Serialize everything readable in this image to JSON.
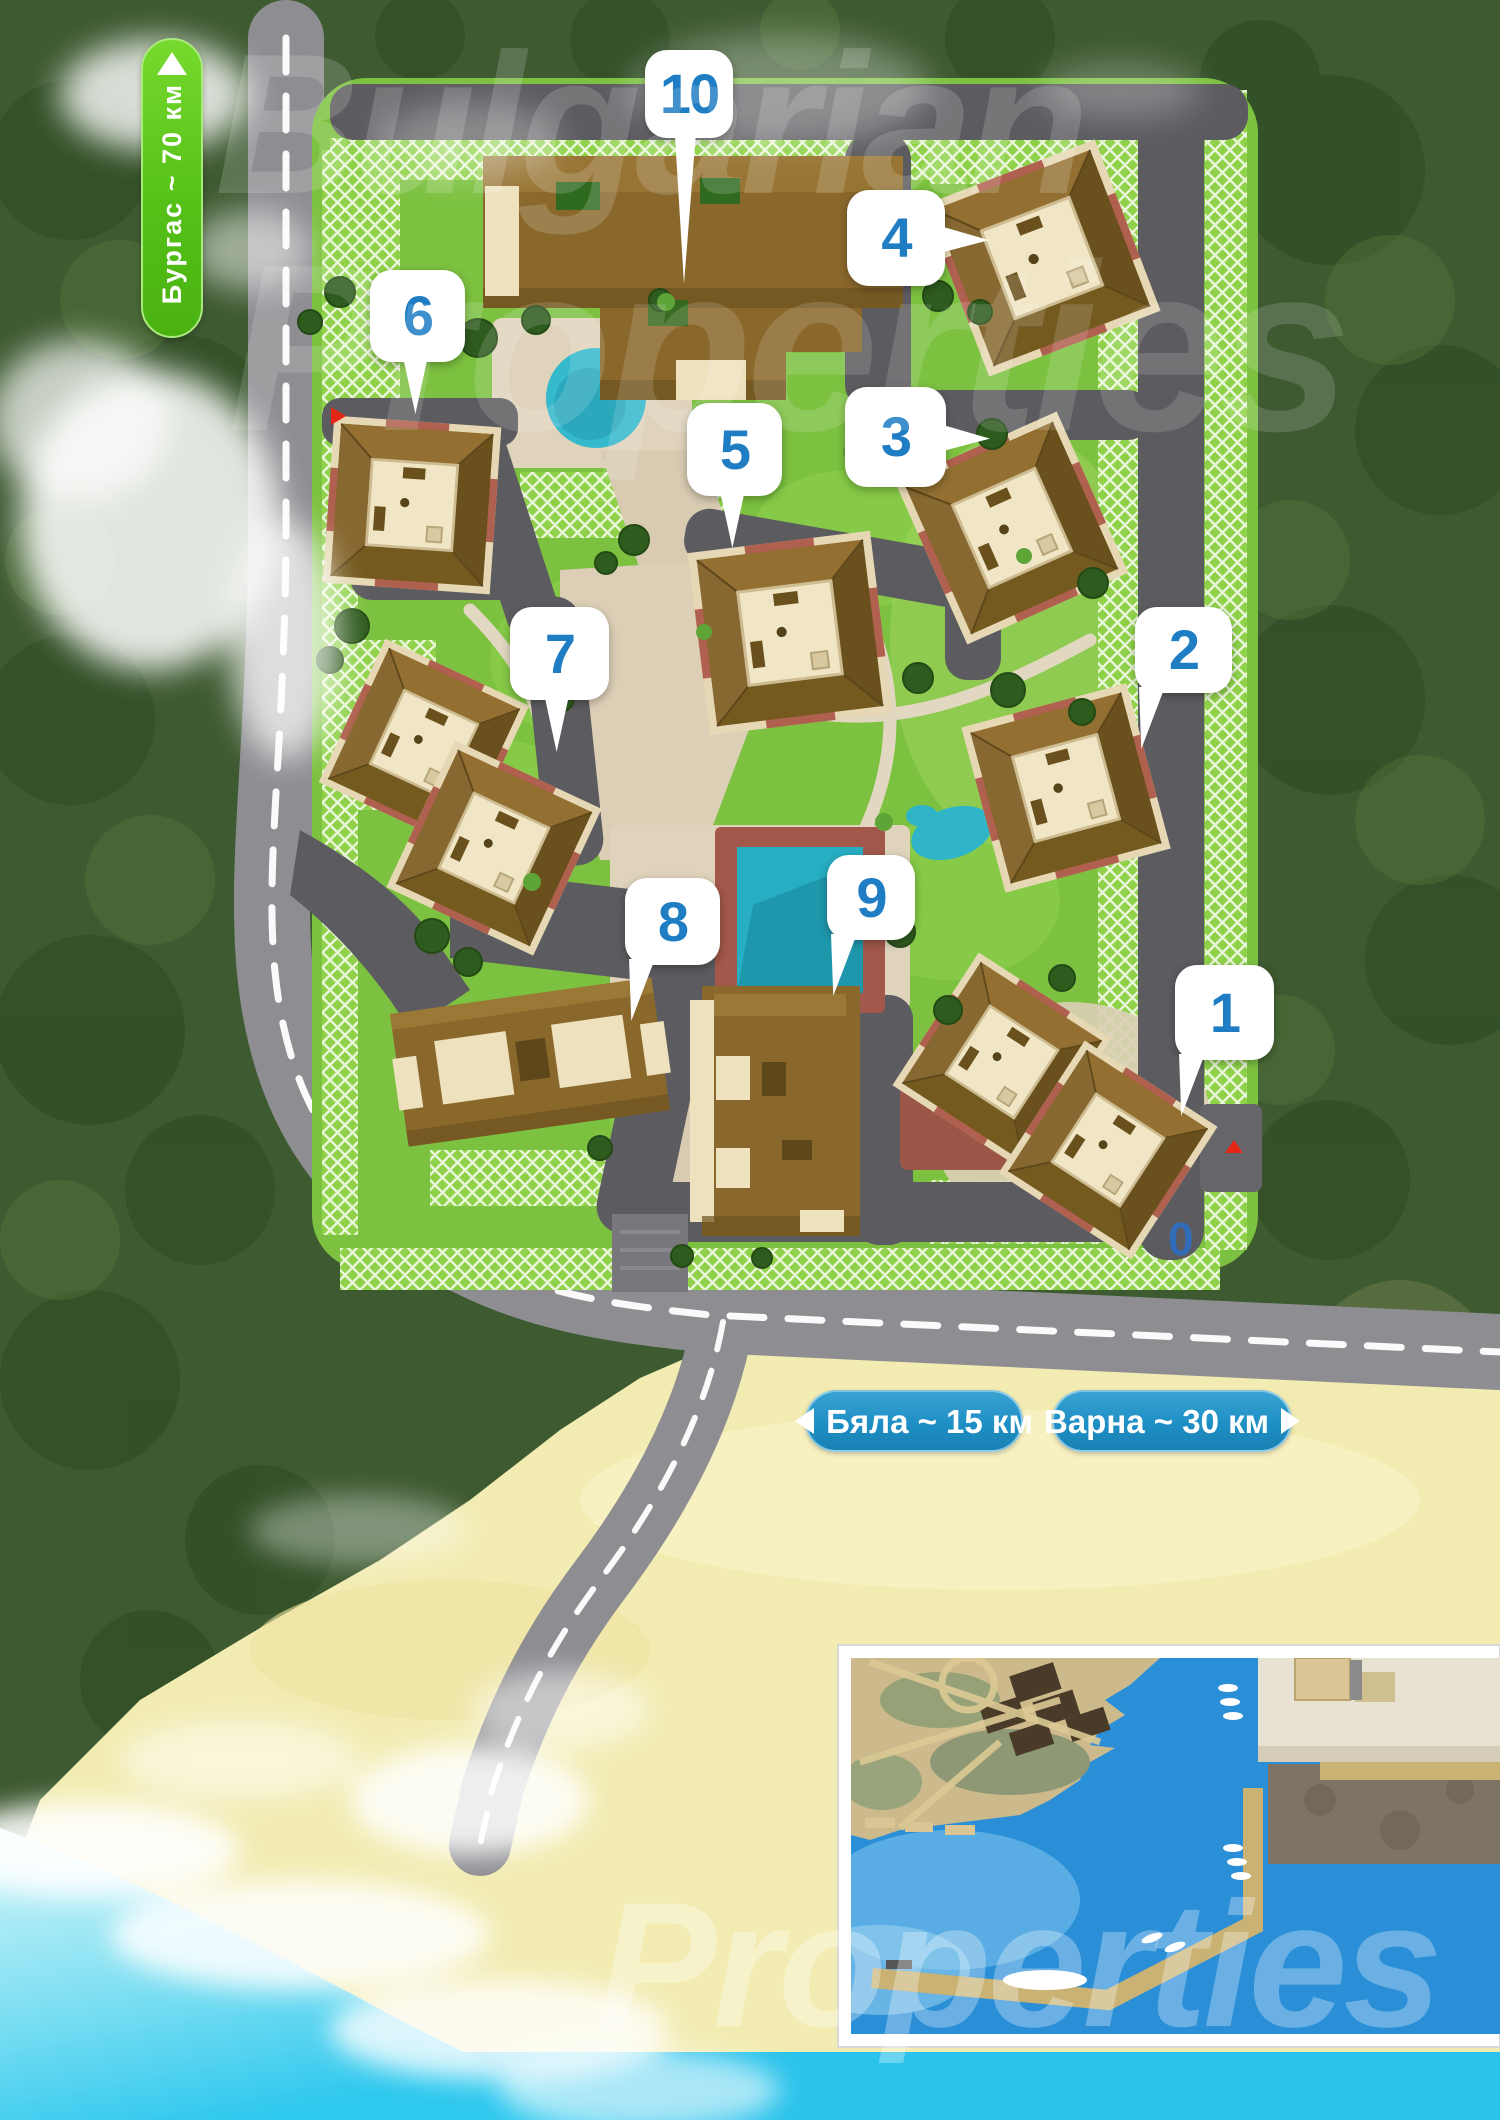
{
  "map": {
    "road_signs": {
      "burgas_label": "Бургас ~ 70 км",
      "byala_label": "Бяла ~ 15 км",
      "varna_label": "Варна ~ 30 км"
    },
    "building_markers": [
      {
        "label": "10",
        "x": 645,
        "y": 50,
        "w": 88,
        "h": 88,
        "tail": "down-long"
      },
      {
        "label": "4",
        "x": 847,
        "y": 190,
        "w": 98,
        "h": 96,
        "tail": "right"
      },
      {
        "label": "6",
        "x": 370,
        "y": 270,
        "w": 95,
        "h": 92,
        "tail": "down"
      },
      {
        "label": "5",
        "x": 687,
        "y": 403,
        "w": 95,
        "h": 93,
        "tail": "down"
      },
      {
        "label": "3",
        "x": 845,
        "y": 387,
        "w": 101,
        "h": 100,
        "tail": "right"
      },
      {
        "label": "7",
        "x": 510,
        "y": 607,
        "w": 99,
        "h": 93,
        "tail": "down"
      },
      {
        "label": "2",
        "x": 1135,
        "y": 607,
        "w": 97,
        "h": 86,
        "tail": "down-left"
      },
      {
        "label": "8",
        "x": 625,
        "y": 878,
        "w": 95,
        "h": 87,
        "tail": "down-left"
      },
      {
        "label": "9",
        "x": 827,
        "y": 855,
        "w": 88,
        "h": 85,
        "tail": "down-left"
      },
      {
        "label": "1",
        "x": 1175,
        "y": 965,
        "w": 99,
        "h": 95,
        "tail": "down-left"
      }
    ],
    "entrance_markers": [
      {
        "dir": "right",
        "x": 331,
        "y": 407
      },
      {
        "dir": "up",
        "x": 1225,
        "y": 1140
      }
    ],
    "watermark": {
      "top_line1": "Bulgarian",
      "top_line2": "Properties",
      "bottom": "Properties",
      "stray_digit": "0"
    },
    "colors": {
      "marker_text": "#1F7DC3",
      "sign_green": "#55C117",
      "banner_blue": "#1E8FC5",
      "sea_cyan": "#2BC3EB"
    }
  }
}
